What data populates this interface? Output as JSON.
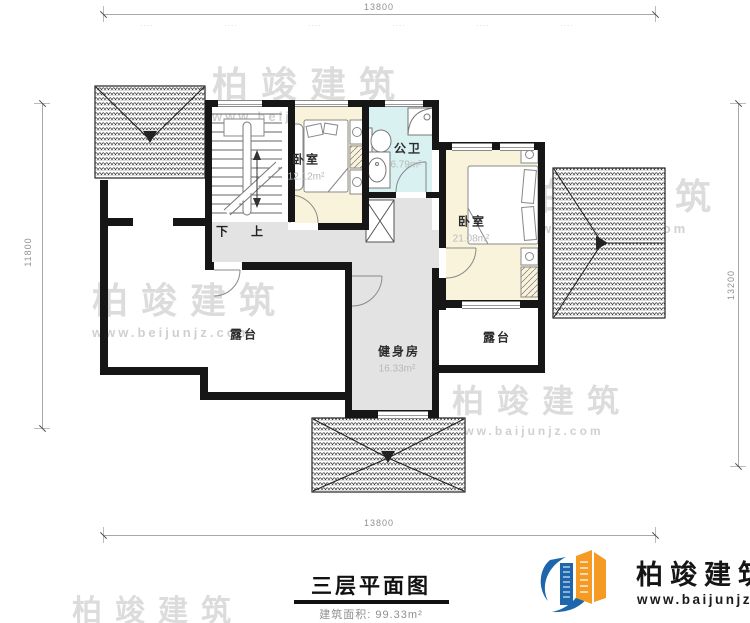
{
  "plan": {
    "title": "三层平面图",
    "area_label": "建筑面积:",
    "area_value": "99.33m²",
    "rooms": {
      "stairs": {
        "down": "下",
        "up": "上"
      },
      "bedroom_small": {
        "name": "卧室",
        "area": "12.12m²"
      },
      "bathroom": {
        "name": "公卫",
        "area": "6.79m²"
      },
      "bedroom_large": {
        "name": "卧室",
        "area": "21.08m²"
      },
      "gym": {
        "name": "健身房",
        "area": "16.33m²"
      },
      "terrace_left": {
        "name": "露台"
      },
      "terrace_right": {
        "name": "露台"
      }
    },
    "dimensions": {
      "top": "13800",
      "bottom": "13800",
      "left": "11800",
      "right": "13200",
      "top_segments": [
        "····",
        "····",
        "····",
        "····",
        "····",
        "····"
      ]
    },
    "colors": {
      "wall": "#161616",
      "bedroom_fill": "#faf3dc",
      "bath_fill": "#d9f1f0",
      "hall_fill": "#e3e3e3",
      "logo_blue": "#1e66ab",
      "logo_orange": "#f59a23"
    }
  },
  "watermark": {
    "brand": "柏竣建筑",
    "url": "www.beijunjz.com",
    "url_alt": "www.baijunjz.com"
  },
  "logo": {
    "brand": "柏竣建筑",
    "url": "www.baijunjz.com"
  }
}
